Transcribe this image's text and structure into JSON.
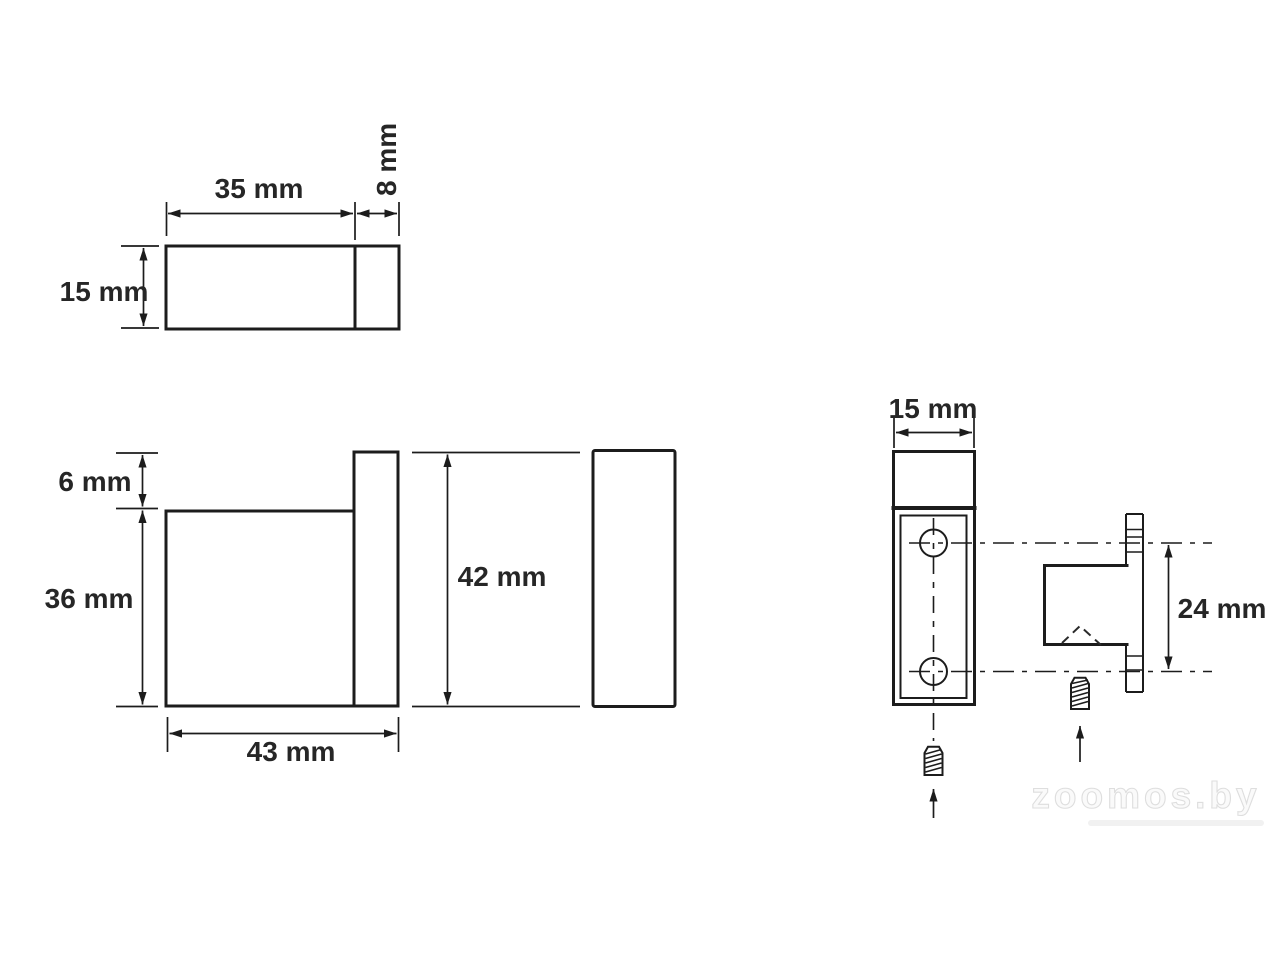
{
  "watermark": "zoomos.by",
  "views": {
    "top": {
      "width": "35 mm",
      "depth": "8 mm",
      "height": "15 mm"
    },
    "side": {
      "top_offset": "6 mm",
      "body_height": "36 mm",
      "total_height": "42 mm",
      "total_width": "43 mm"
    },
    "front": {
      "width": "15 mm"
    },
    "mounting": {
      "hole_spacing": "24 mm"
    }
  }
}
